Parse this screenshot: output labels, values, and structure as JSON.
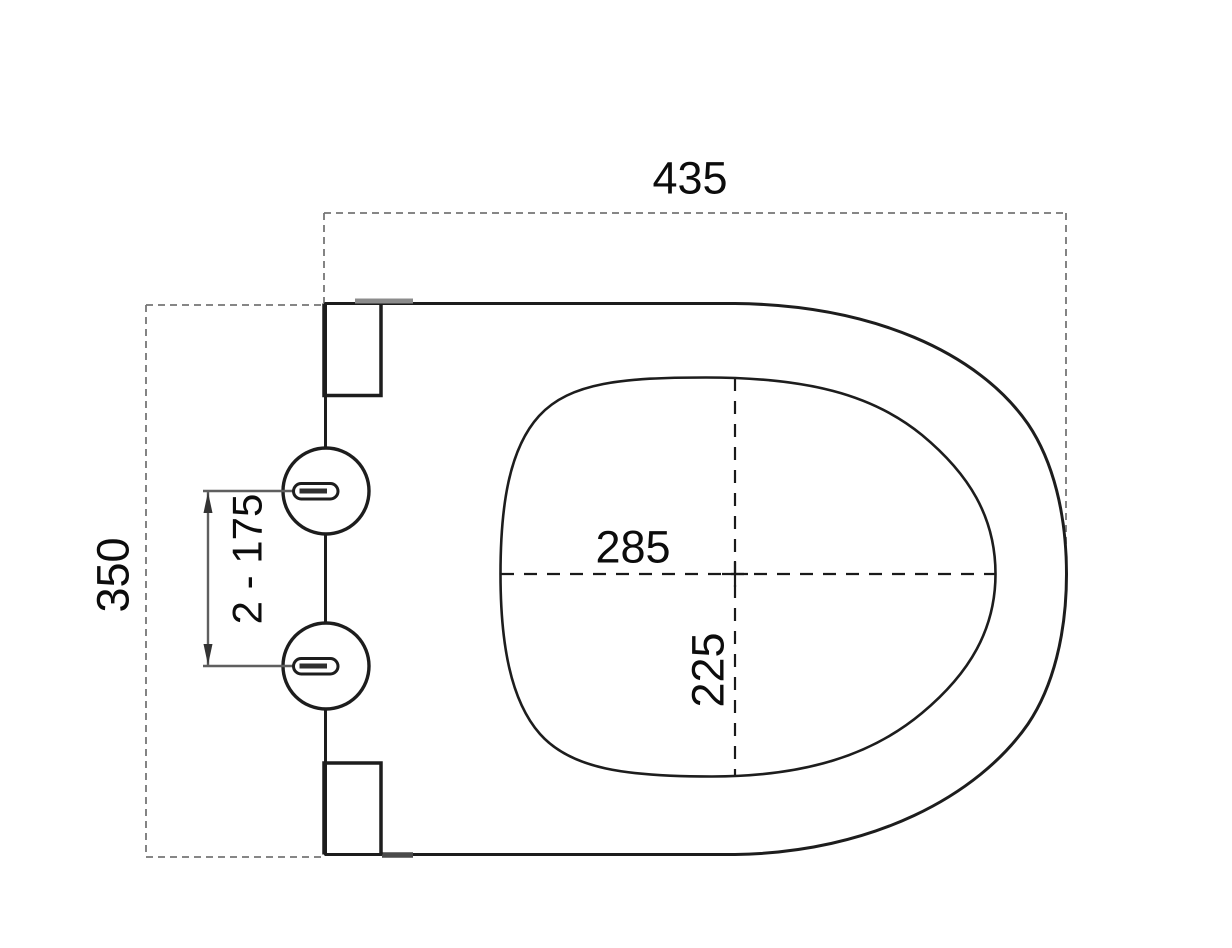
{
  "drawing": {
    "labels": {
      "overall_width": "435",
      "overall_depth": "350",
      "hinge_spacing": "2 - 175",
      "inner_width": "285",
      "inner_depth": "225"
    },
    "values": {
      "overall_width_mm": 435,
      "overall_depth_mm": 350,
      "inner_width_mm": 285,
      "inner_depth_mm": 225
    },
    "colors": {
      "background": "#ffffff",
      "outline": "#1d1d1d",
      "extent_dotted_line": "#767676",
      "centerline_dashed": "#1a1a1a",
      "dimension_line": "#5f5f5f",
      "arrow": "#333333",
      "hinge_plate_edge": "#8c8c8c",
      "label_text": "#0c0c0c"
    }
  }
}
